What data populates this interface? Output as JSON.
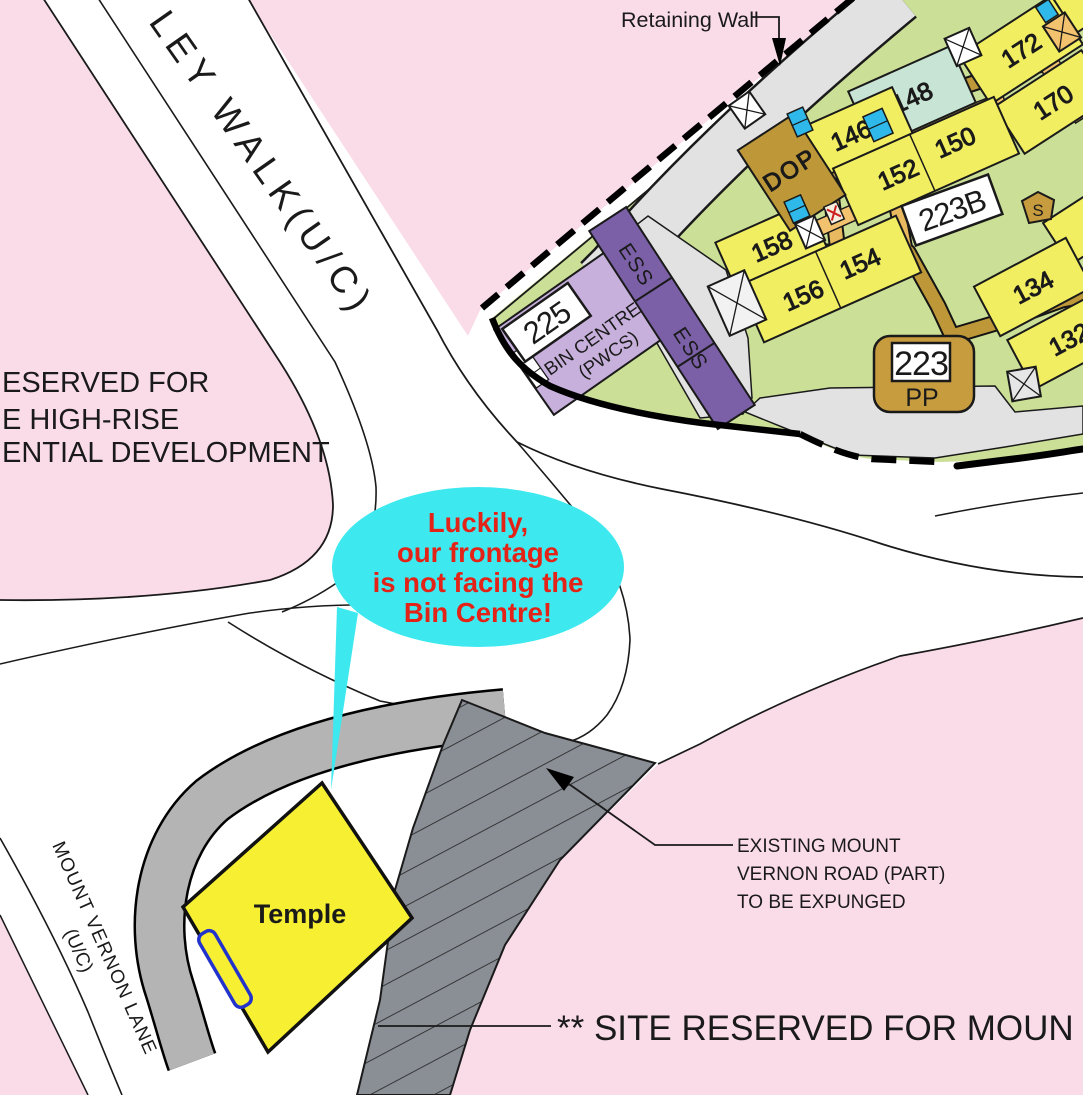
{
  "map": {
    "roads": {
      "ley_walk": "LEY WALK(U/C)",
      "mount_vernon_lane": "MOUNT VERNON LANE",
      "mount_vernon_lane_status": "(U/C)"
    },
    "annotations": {
      "retaining_wall": "Retaining Wall",
      "reserved_l1": "ESERVED FOR",
      "reserved_l2": "E HIGH-RISE",
      "reserved_l3": "ENTIAL  DEVELOPMENT",
      "expunged_l1": "EXISTING MOUNT",
      "expunged_l2": "VERNON ROAD (PART)",
      "expunged_l3": "TO BE EXPUNGED",
      "site_reserved": "** SITE RESERVED FOR MOUN"
    },
    "bubble": {
      "l1": "Luckily,",
      "l2": "our frontage",
      "l3": "is not facing the",
      "l4": "Bin Centre!"
    },
    "temple": {
      "label": "Temple"
    },
    "blocks": {
      "b172": "172",
      "b170": "170",
      "b148": "148",
      "b146": "146",
      "b150": "150",
      "b152": "152",
      "b158": "158",
      "b156": "156",
      "b154": "154",
      "b134": "134",
      "b132": "132",
      "b223b": "223B",
      "b223": "223",
      "pp": "PP",
      "b225": "225"
    },
    "facilities": {
      "bin_centre_l1": "BIN CENTRE",
      "bin_centre_l2": "(PWCS)",
      "ess": "ESS",
      "dop": "DOP",
      "substation": "S"
    },
    "colors": {
      "pink": "#FADCE9",
      "green": "#CBDF97",
      "building_yellow": "#F2EE61",
      "temple_yellow": "#F7F032",
      "teal": "#C7E4D4",
      "lavender": "#C7B0DB",
      "purple": "#7B60A8",
      "gold_path": "#BE9838",
      "tan": "#C79C3E",
      "orange": "#F2C26E",
      "cyan_marker": "#2FB9EA",
      "bubble_cyan": "#3DE9EF",
      "bubble_text_red": "#E42318",
      "road_gray": "#E2E2E3",
      "footpath_gray": "#B4B4B5",
      "expunged_gray": "#8A8E95"
    }
  }
}
